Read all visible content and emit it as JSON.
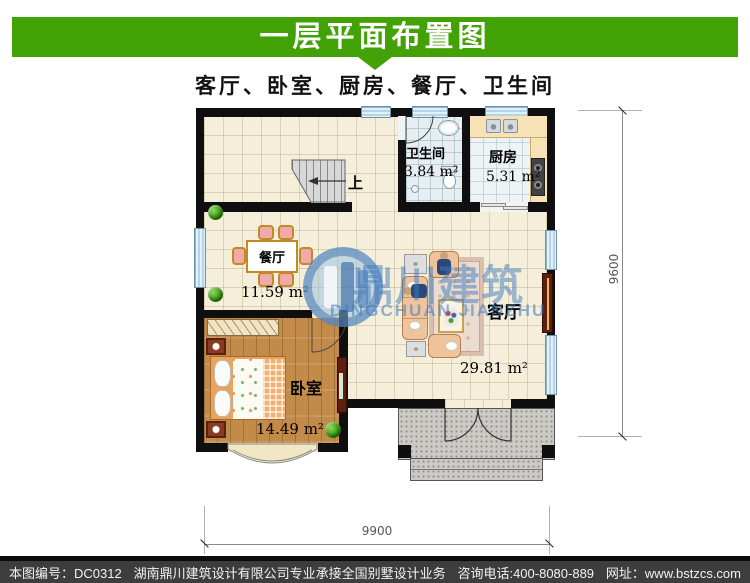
{
  "banner": {
    "title": "一层平面布置图"
  },
  "subtitle": {
    "text": "客厅、卧室、厨房、餐厅、卫生间"
  },
  "rooms": {
    "bathroom": {
      "name": "卫生间",
      "area": "3.84 m²"
    },
    "kitchen": {
      "name": "厨房",
      "area": "5.31 m²"
    },
    "dining": {
      "name": "餐厅",
      "area": "11.59 m²"
    },
    "living": {
      "name": "客厅",
      "area": "29.81 m²"
    },
    "bedroom": {
      "name": "卧室",
      "area": "14.49 m²"
    }
  },
  "stairs": {
    "direction_label": "上"
  },
  "dimensions": {
    "vertical": "9600",
    "horizontal": "9900"
  },
  "watermark": {
    "name_cn": "鼎川建筑",
    "name_en": "DINGCHUAN JIANZHU"
  },
  "footer": {
    "drawing_no": "本图编号：DC0312",
    "company": "湖南鼎川建筑设计有限公司专业承接全国别墅设计业务",
    "hotline": "咨询电话:400-8080-889",
    "website": "网址：www.bstzcs.com"
  },
  "colors": {
    "banner_green": "#42a104",
    "wall_black": "#0f0f0f",
    "window_blue": "#e2f1f9",
    "footer_gray": "#3d3d3d"
  }
}
